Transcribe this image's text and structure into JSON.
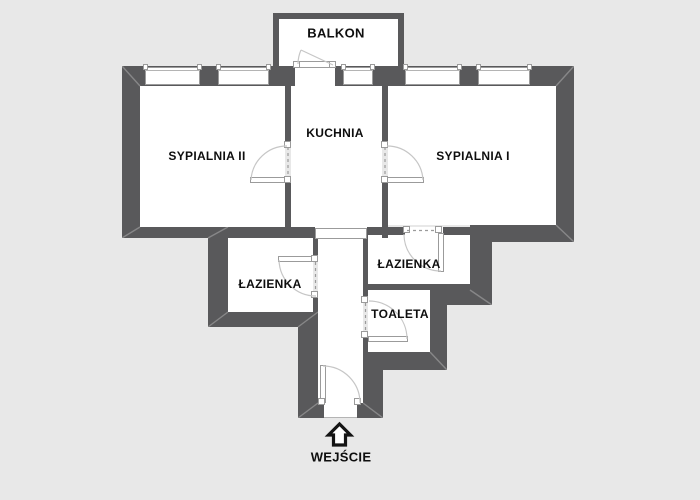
{
  "title": "Rzut mieszkania",
  "colors": {
    "background": "#e8e8e8",
    "wall": "#59595b",
    "room": "#ffffff",
    "frame": "#9b9b9b",
    "glass": "#b4b4b4",
    "arc": "#c6c6c6",
    "dash": "#9b9b9b",
    "miter": "rgba(255,255,255,0.28)",
    "text": "#0e0e0e",
    "arrow_stroke": "#141414",
    "arrow_fill": "#ffffff"
  },
  "labels": {
    "balkon": {
      "text": "BALKON",
      "cx": 336,
      "cy": 33,
      "size": 13
    },
    "sypialnia2": {
      "text": "SYPIALNIA II",
      "cx": 207,
      "cy": 156,
      "size": 12
    },
    "kuchnia": {
      "text": "KUCHNIA",
      "cx": 335,
      "cy": 133,
      "size": 12
    },
    "sypialnia1": {
      "text": "SYPIALNIA I",
      "cx": 473,
      "cy": 156,
      "size": 12
    },
    "lazienka_left": {
      "text": "ŁAZIENKA",
      "cx": 270,
      "cy": 284,
      "size": 12
    },
    "lazienka_right": {
      "text": "ŁAZIENKA",
      "cx": 409,
      "cy": 264,
      "size": 12
    },
    "toaleta": {
      "text": "TOALETA",
      "cx": 400,
      "cy": 314,
      "size": 12
    },
    "wejscie": {
      "text": "WEJŚCIE",
      "cx": 341,
      "cy": 457,
      "size": 13
    }
  },
  "geometry": {
    "rooms": [
      {
        "name": "room-balkon",
        "x": 279,
        "y": 19,
        "w": 119,
        "h": 47
      },
      {
        "name": "room-sypialnia-2",
        "x": 140,
        "y": 86,
        "w": 145,
        "h": 141
      },
      {
        "name": "room-kuchnia",
        "x": 291,
        "y": 86,
        "w": 91,
        "h": 144
      },
      {
        "name": "room-sypialnia-1",
        "x": 388,
        "y": 86,
        "w": 168,
        "h": 139
      },
      {
        "name": "room-lazienka-left",
        "x": 228,
        "y": 238,
        "w": 85,
        "h": 74
      },
      {
        "name": "room-lazienka-right",
        "x": 368,
        "y": 235,
        "w": 102,
        "h": 50
      },
      {
        "name": "room-toaleta",
        "x": 368,
        "y": 290,
        "w": 62,
        "h": 62
      },
      {
        "name": "room-korytarz",
        "x": 318,
        "y": 230,
        "w": 45,
        "h": 188
      }
    ],
    "walls": [
      [
        122,
        66,
        452,
        20
      ],
      [
        122,
        66,
        18,
        172
      ],
      [
        556,
        66,
        18,
        176
      ],
      [
        122,
        227,
        193,
        11
      ],
      [
        367,
        227,
        103,
        8
      ],
      [
        470,
        225,
        104,
        17
      ],
      [
        208,
        238,
        20,
        89
      ],
      [
        208,
        312,
        110,
        15
      ],
      [
        313,
        238,
        5,
        20
      ],
      [
        313,
        296,
        5,
        16
      ],
      [
        298,
        327,
        20,
        91
      ],
      [
        363,
        230,
        5,
        72
      ],
      [
        363,
        336,
        5,
        16
      ],
      [
        363,
        284,
        107,
        6
      ],
      [
        430,
        290,
        62,
        15
      ],
      [
        470,
        228,
        22,
        77
      ],
      [
        430,
        290,
        17,
        80
      ],
      [
        363,
        352,
        84,
        18
      ],
      [
        363,
        352,
        20,
        66
      ],
      [
        298,
        403,
        85,
        15
      ],
      [
        285,
        86,
        6,
        57
      ],
      [
        285,
        183,
        6,
        55
      ],
      [
        382,
        86,
        6,
        57
      ],
      [
        382,
        183,
        6,
        55
      ],
      [
        273,
        13,
        6,
        53
      ],
      [
        273,
        13,
        131,
        6
      ],
      [
        398,
        13,
        6,
        53
      ]
    ],
    "openings": [
      {
        "x": 295,
        "y": 66,
        "w": 40,
        "h": 20,
        "border": false
      },
      {
        "x": 315,
        "y": 228,
        "w": 52,
        "h": 11,
        "border": true
      },
      {
        "x": 324,
        "y": 403,
        "w": 33,
        "h": 15,
        "border": false
      },
      {
        "x": 405,
        "y": 227,
        "w": 38,
        "h": 8,
        "border": false
      }
    ],
    "windows": [
      {
        "x": 145,
        "w": 55
      },
      {
        "x": 218,
        "w": 51
      },
      {
        "x": 343,
        "w": 30
      },
      {
        "x": 405,
        "w": 55
      },
      {
        "x": 478,
        "w": 52
      }
    ],
    "window_y": 67,
    "window_h": 18,
    "panels": [
      [
        250,
        177,
        37,
        6
      ],
      [
        387,
        177,
        37,
        6
      ],
      [
        278,
        256,
        39,
        6
      ],
      [
        438,
        233,
        6,
        39
      ],
      [
        368,
        336,
        40,
        6
      ],
      [
        320,
        365,
        6,
        38
      ],
      [
        297,
        61,
        37,
        7
      ]
    ],
    "squares": [
      [
        284,
        141
      ],
      [
        284,
        176
      ],
      [
        381,
        141
      ],
      [
        381,
        176
      ],
      [
        311,
        255
      ],
      [
        311,
        291
      ],
      [
        403,
        226
      ],
      [
        435,
        226
      ],
      [
        361,
        296
      ],
      [
        361,
        331
      ],
      [
        318,
        398
      ],
      [
        354,
        398
      ],
      [
        293,
        61
      ],
      [
        329,
        61
      ]
    ],
    "dashes": [
      [
        288,
        147,
        288,
        176
      ],
      [
        385,
        147,
        385,
        176
      ],
      [
        315.5,
        262,
        315.5,
        290
      ],
      [
        407,
        230.5,
        436,
        230.5
      ],
      [
        365.5,
        303,
        365.5,
        330
      ]
    ],
    "arcs": [
      "M 251 180 A 36 36 0 0 1 287 146",
      "M 423 180 A 36 36 0 0 0 387 146",
      "M 279 260 A 37 37 0 0 0 316 296",
      "M 441 271 A 37 37 0 0 1 404 234",
      "M 407 339 A 38 38 0 0 0 369 301",
      "M 323 366 A 37 37 0 0 1 360 403",
      "M 301 50 A 35 35 0 0 0 298 64"
    ],
    "swing_lines": [
      [
        333,
        65,
        301,
        50
      ]
    ],
    "threshold_lines": [
      [
        324,
        417.5,
        357,
        417.5
      ]
    ],
    "miters": [
      [
        122,
        66,
        140,
        86
      ],
      [
        574,
        66,
        556,
        86
      ],
      [
        122,
        238,
        140,
        227
      ],
      [
        208,
        238,
        228,
        227
      ],
      [
        208,
        327,
        228,
        312
      ],
      [
        298,
        327,
        318,
        312
      ],
      [
        298,
        418,
        318,
        403
      ],
      [
        383,
        418,
        363,
        403
      ],
      [
        447,
        370,
        430,
        352
      ],
      [
        492,
        305,
        470,
        290
      ],
      [
        574,
        242,
        556,
        225
      ]
    ],
    "arrow_path": "M 339.5 424 L 350.5 435 L 345.5 435 L 345.5 445 L 333.5 445 L 333.5 435 L 328.5 435 Z"
  }
}
